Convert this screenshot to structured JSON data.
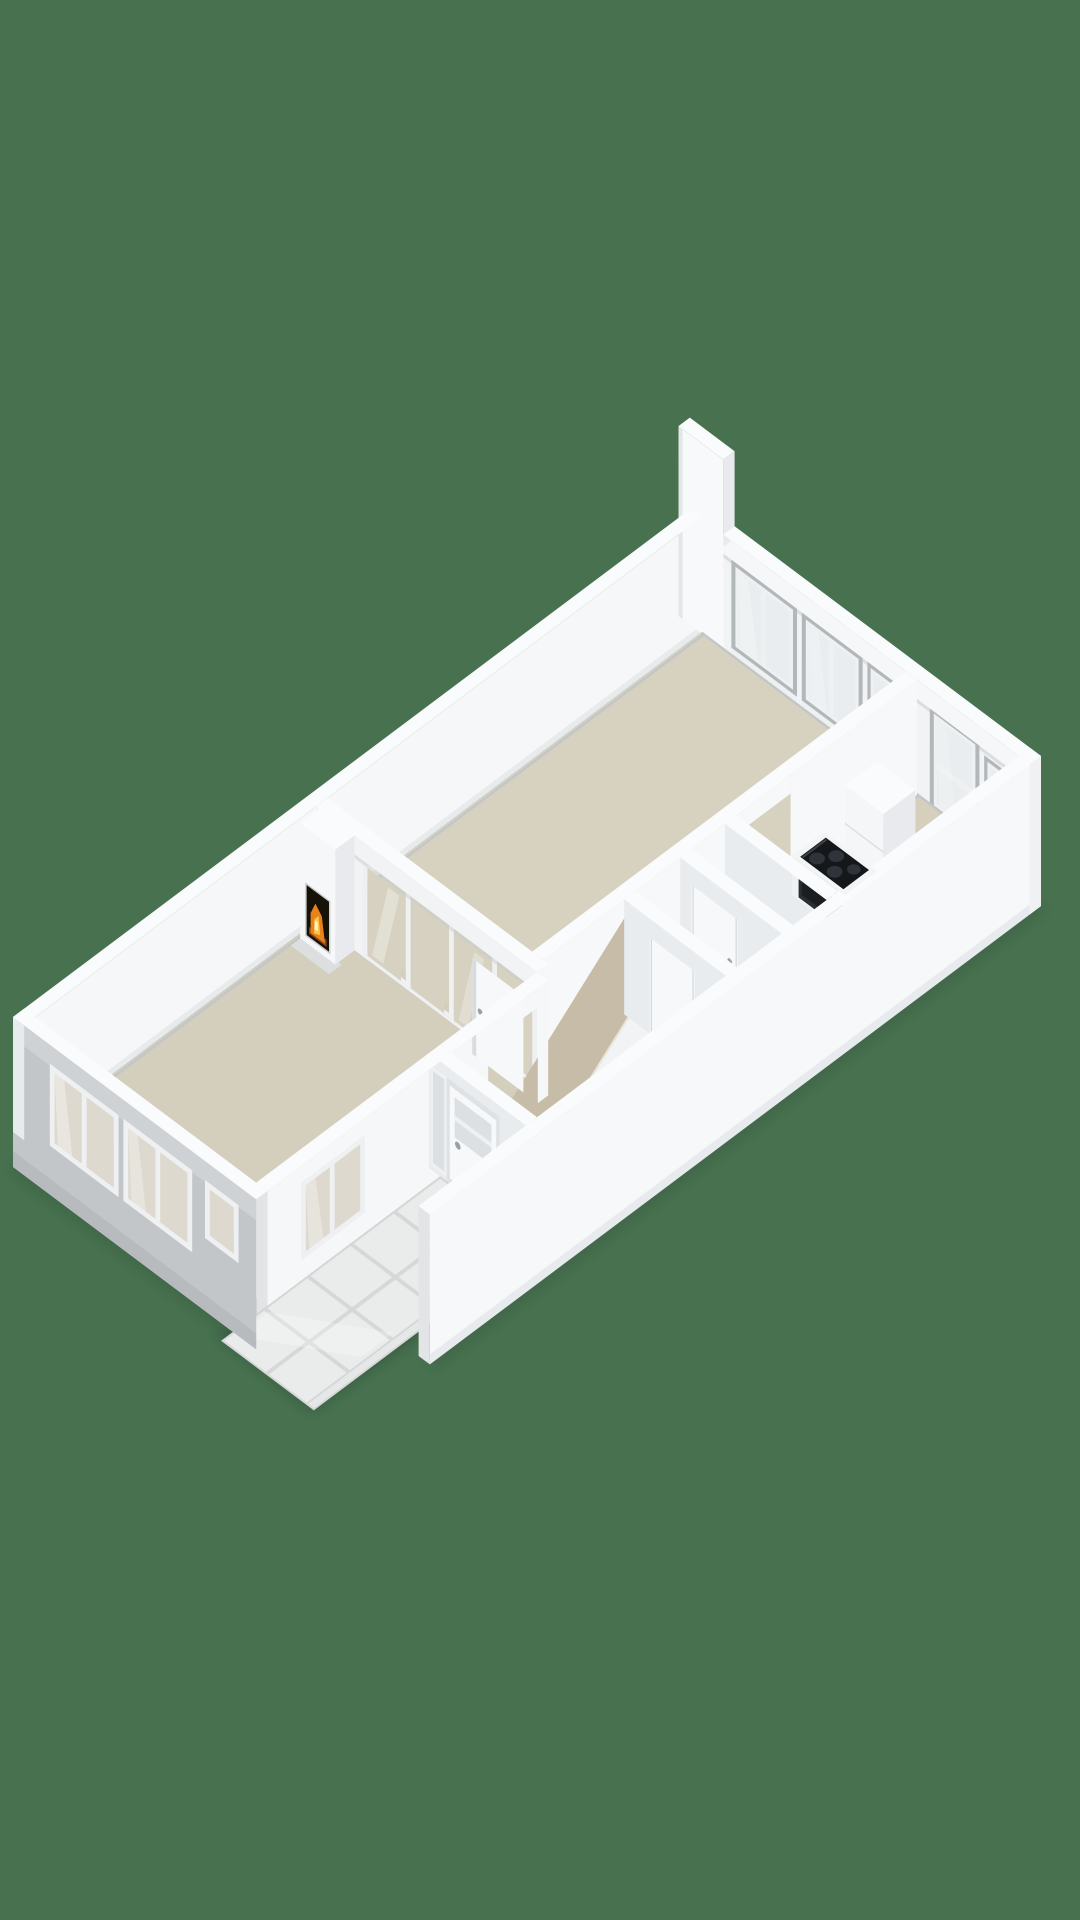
{
  "scene": {
    "background": "#47714f",
    "subject": "3d-floorplan-isometric-render"
  },
  "palette": {
    "background": "#47714f",
    "wall_top": "#fafbfc",
    "wall_inner": "#f1f3f5",
    "wall_bright": "#f5f7f8",
    "wall_shaded": "#e9ecee",
    "wall_end": "#e2e4e6",
    "ext_gray": "#c2c6c9",
    "ext_bright": "#f6f8f9",
    "fin_white": "#f7f9fa",
    "ramp": "#c6bca7",
    "stringer": "#f1f3f5",
    "tile": "#eaecec",
    "tile_gap": "#d5d7d8",
    "glass_ext": "#e9edef",
    "glass_sw": "#ddd9ce",
    "glass_int": "#d6d1c0",
    "glass_door": "#dce0e2",
    "frame_gray": "#b2b7ba",
    "frame_white": "#eef0f2",
    "skirting": "#c3c6c8",
    "mat": "#85898c",
    "door_white": "#f6f8f9",
    "handle": "#9aa0a4",
    "counter": "#f2f4f5",
    "counter_face": "#eef0f3",
    "cooktop": "#15181b",
    "burner": "#2f343a",
    "oven": "#2b2e31",
    "oven_handle": "#c5cacd",
    "oven_glass": "#1b1e21",
    "cabinet": "#f4f6f8",
    "cabinet_side": "#e8eaed",
    "hearth": "#dcdedf",
    "firebox": "#171208",
    "shadow": "#16281c",
    "fixture_white": "#f3f5f6"
  },
  "floorplan": {
    "rooms": [
      {
        "name": "living-room",
        "floor": "#d4cebc"
      },
      {
        "name": "main-room",
        "floor": "#d7d1bf"
      },
      {
        "name": "hall",
        "floor": "#d0cab7"
      },
      {
        "name": "bathroom",
        "floor": "#cec8b5"
      },
      {
        "name": "wc",
        "floor": "#cec8b5"
      },
      {
        "name": "kitchen",
        "floor": "#d5cfbc"
      },
      {
        "name": "porch",
        "floor": "#eaecec"
      }
    ],
    "features": [
      "fireplace",
      "staircase",
      "glazed-partition",
      "kitchen-counter",
      "cooktop",
      "oven",
      "tall-cabinet",
      "front-door",
      "doormat",
      "tiled-porch",
      "open-door"
    ],
    "fire": {
      "ember": "#8f3f10",
      "flame": "#e8821a",
      "flame_bright": "#ffc545",
      "core": "#fff3c8"
    }
  }
}
